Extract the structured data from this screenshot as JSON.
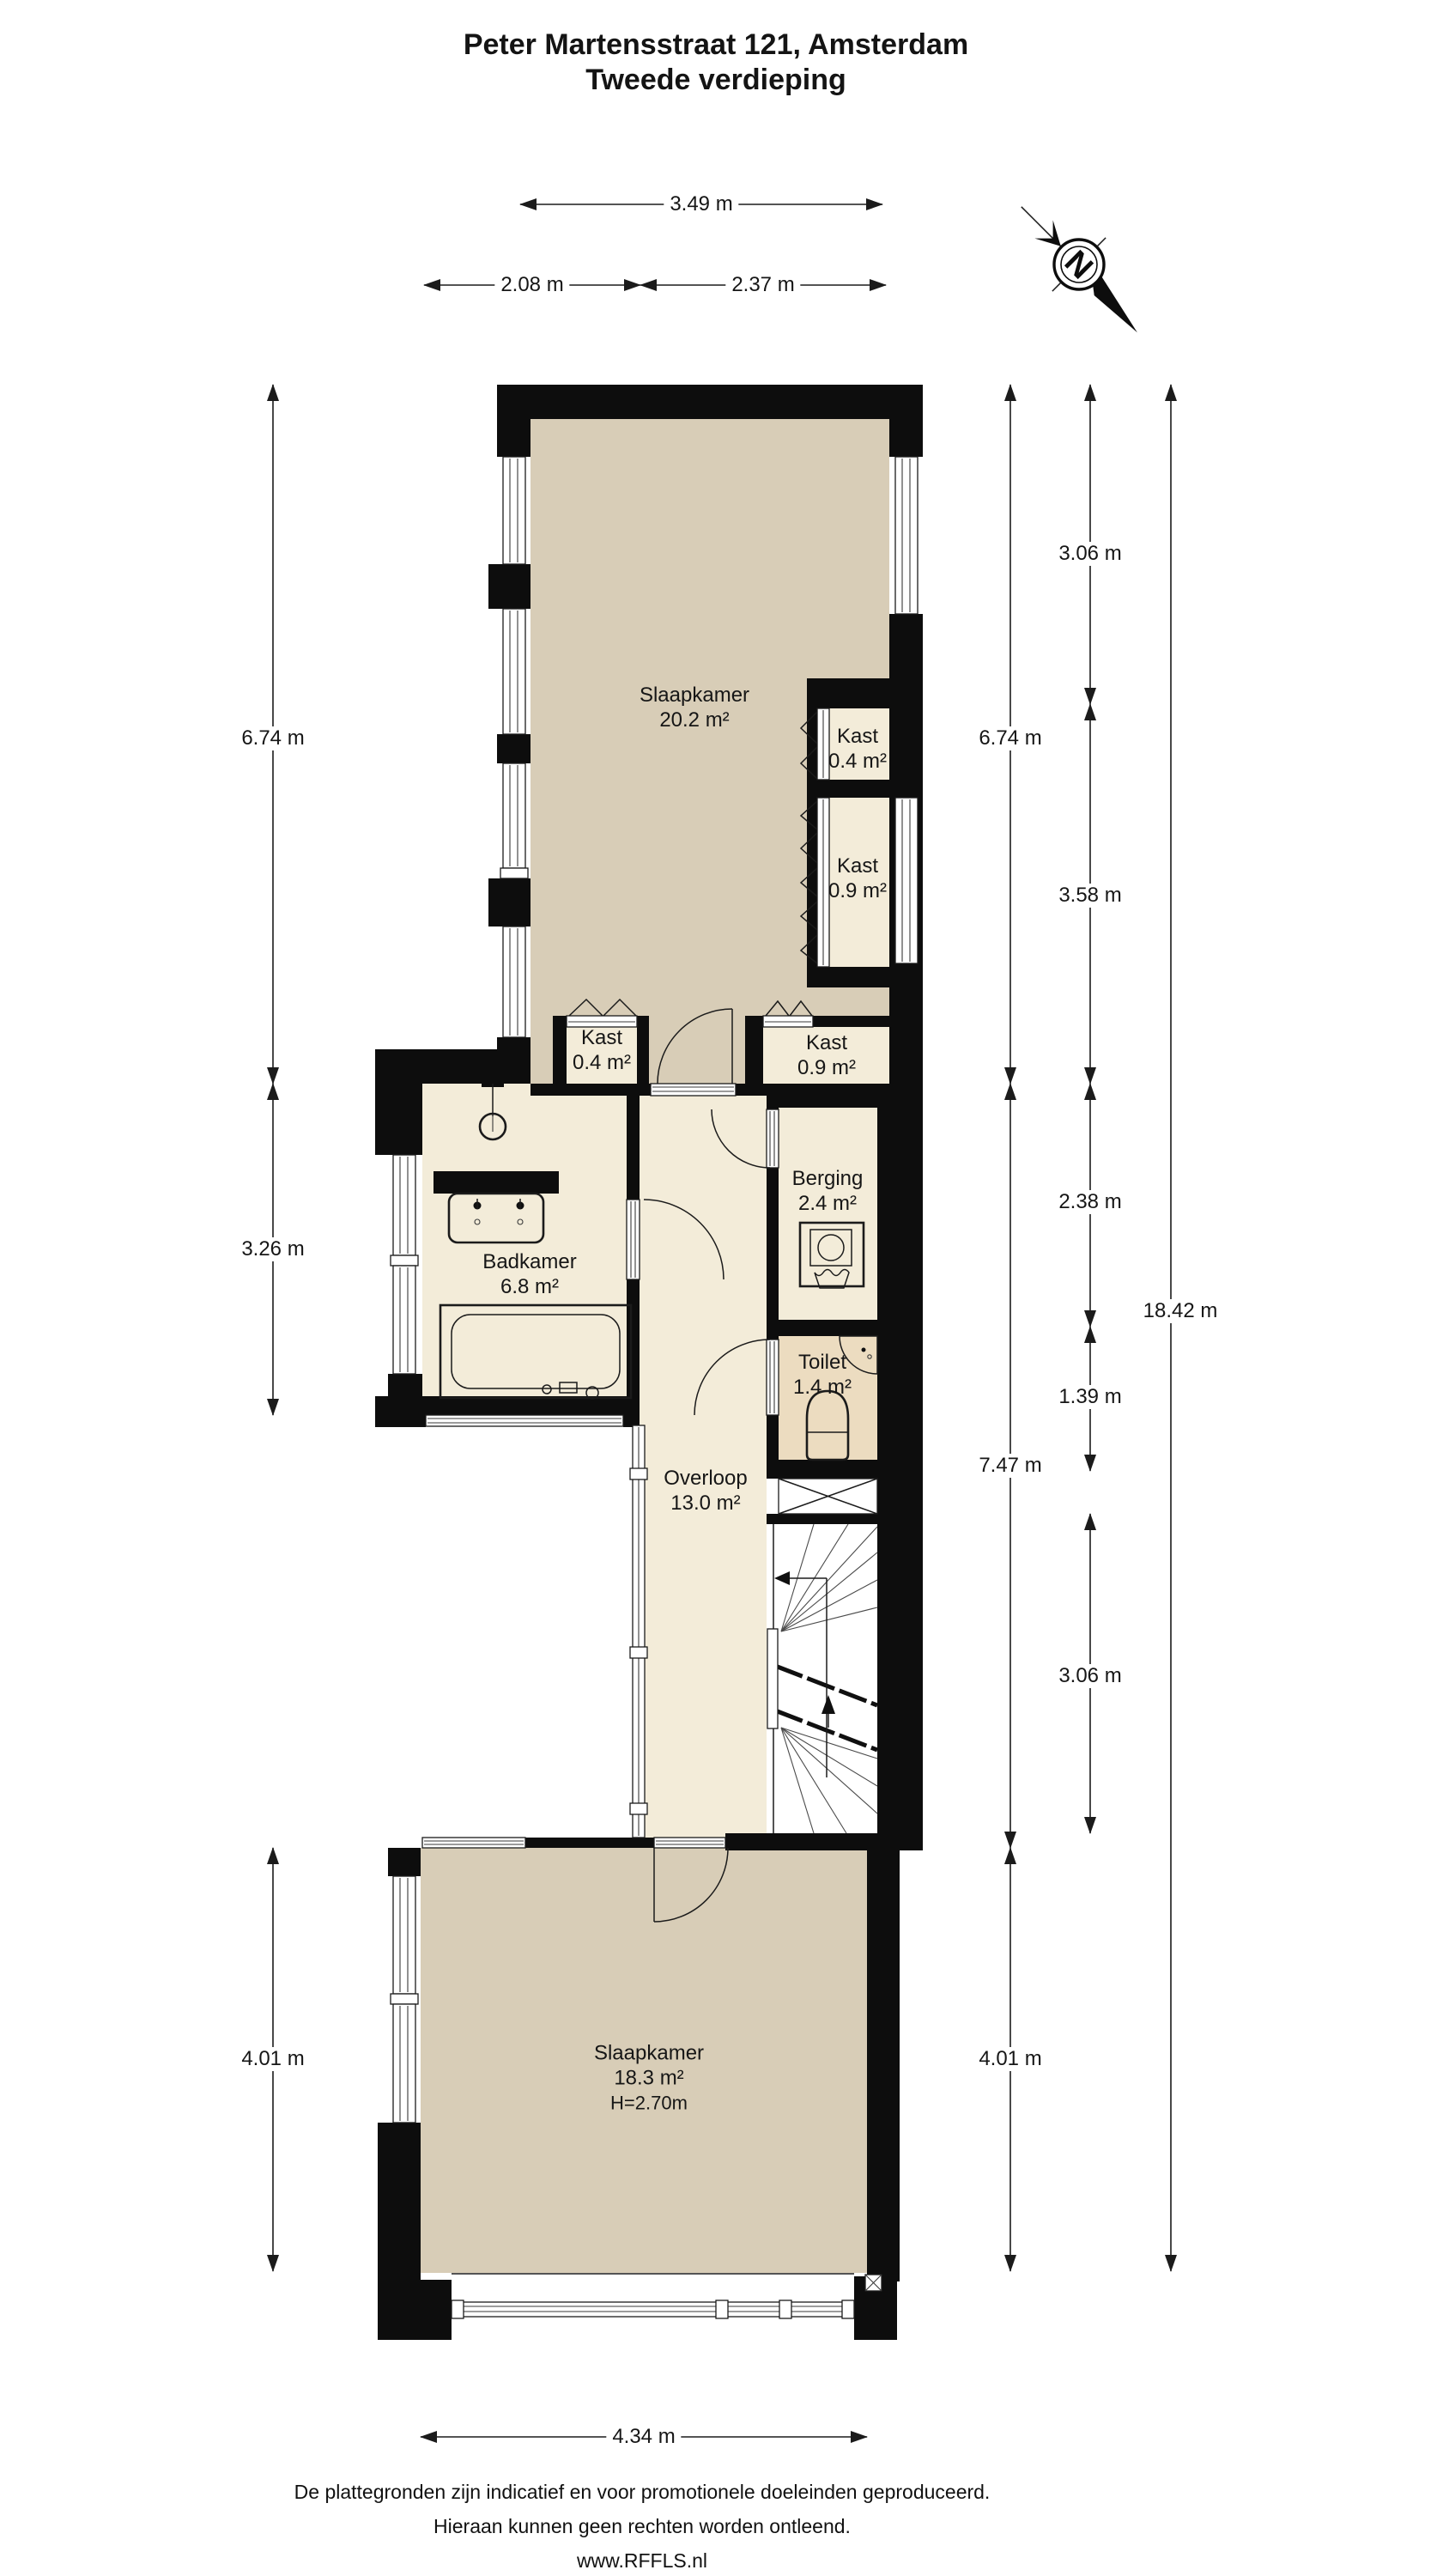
{
  "title": {
    "line1": "Peter Martensstraat 121, Amsterdam",
    "line2": "Tweede verdieping"
  },
  "compass": {
    "label": "N"
  },
  "rooms": {
    "slaapkamer_boven": {
      "name": "Slaapkamer",
      "area": "20.2 m²"
    },
    "kast_04_boven": {
      "name": "Kast",
      "area": "0.4 m²"
    },
    "kast_09_rechts": {
      "name": "Kast",
      "area": "0.9 m²"
    },
    "kast_04_onder": {
      "name": "Kast",
      "area": "0.4 m²"
    },
    "kast_09_onder": {
      "name": "Kast",
      "area": "0.9 m²"
    },
    "badkamer": {
      "name": "Badkamer",
      "area": "6.8 m²"
    },
    "berging": {
      "name": "Berging",
      "area": "2.4 m²"
    },
    "toilet": {
      "name": "Toilet",
      "area": "1.4 m²"
    },
    "overloop": {
      "name": "Overloop",
      "area": "13.0 m²"
    },
    "slaapkamer_onder": {
      "name": "Slaapkamer",
      "area": "18.3 m²",
      "height": "H=2.70m"
    }
  },
  "dimensions": {
    "top_total": "3.49 m",
    "top_left": "2.08 m",
    "top_right": "2.37 m",
    "left_upper": "6.74 m",
    "left_middle": "3.26 m",
    "left_lower": "4.01 m",
    "right_inner_upper": "6.74 m",
    "right_inner_middle": "7.47 m",
    "right_inner_lower": "4.01 m",
    "right_mid_1": "3.06 m",
    "right_mid_2": "3.58 m",
    "right_mid_3": "2.38 m",
    "right_mid_4": "1.39 m",
    "right_mid_5": "3.06 m",
    "right_total": "18.42 m",
    "bottom": "4.34 m"
  },
  "footer": {
    "line1": "De plattegronden zijn indicatief en voor promotionele doeleinden geproduceerd.",
    "line2": "Hieraan kunnen geen rechten worden ontleend.",
    "line3": "www.RFFLS.nl"
  },
  "colors": {
    "wall": "#0d0d0d",
    "room_tan": "#d8cdb7",
    "room_cream": "#f3ecd9",
    "room_toilet": "#ecdcc0"
  }
}
